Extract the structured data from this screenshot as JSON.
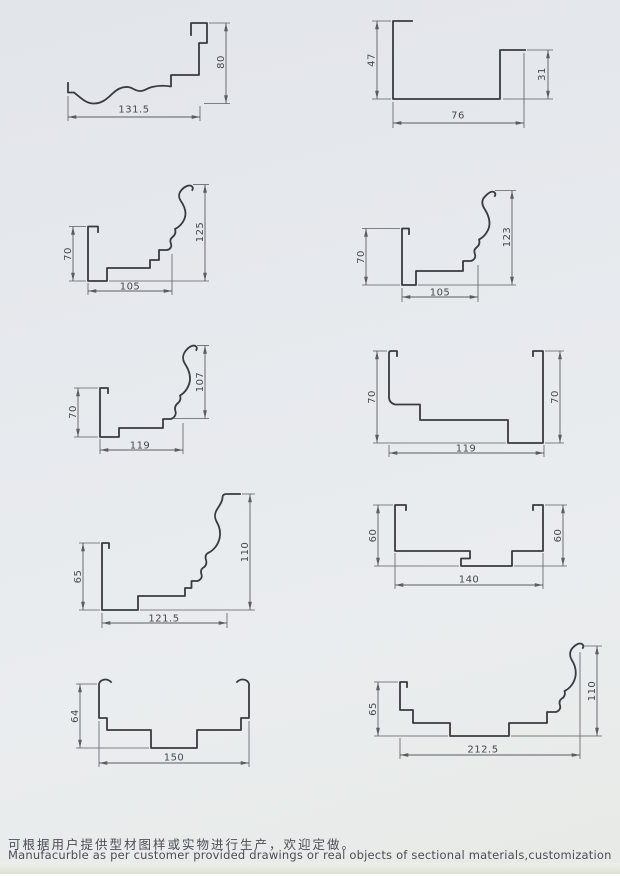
{
  "footer": {
    "line_cn": "可根据用户提供型材图样或实物进行生产，欢迎定做。",
    "line_en": "Manufacurble as per customer provided drawings or real objects of sectional materials,customization is welcome."
  },
  "figures": [
    {
      "type": "wavy-fascia-profile",
      "dimensions": {
        "height": "80",
        "bottom": "131.5"
      }
    },
    {
      "type": "u-channel-profile",
      "dimensions": {
        "left": "47",
        "bottom": "76",
        "right": "31"
      }
    },
    {
      "type": "crown-molding-profile",
      "dimensions": {
        "left": "70",
        "bottom": "105",
        "right": "125"
      }
    },
    {
      "type": "crown-molding-profile",
      "dimensions": {
        "left": "70",
        "bottom": "105",
        "right": "123"
      }
    },
    {
      "type": "crown-molding-profile",
      "dimensions": {
        "left": "70",
        "bottom": "119",
        "right": "107"
      }
    },
    {
      "type": "stepped-channel-profile",
      "dimensions": {
        "left": "70",
        "bottom": "119",
        "right": "70"
      }
    },
    {
      "type": "crown-molding-profile",
      "dimensions": {
        "left": "65",
        "bottom": "121.5",
        "right": "110"
      }
    },
    {
      "type": "hat-channel-profile",
      "dimensions": {
        "left": "60",
        "bottom": "140",
        "right": "60"
      }
    },
    {
      "type": "curled-channel-profile",
      "dimensions": {
        "left": "64",
        "bottom": "150"
      }
    },
    {
      "type": "gutter-crown-profile",
      "dimensions": {
        "left": "65",
        "bottom": "212.5",
        "right": "110"
      }
    }
  ]
}
